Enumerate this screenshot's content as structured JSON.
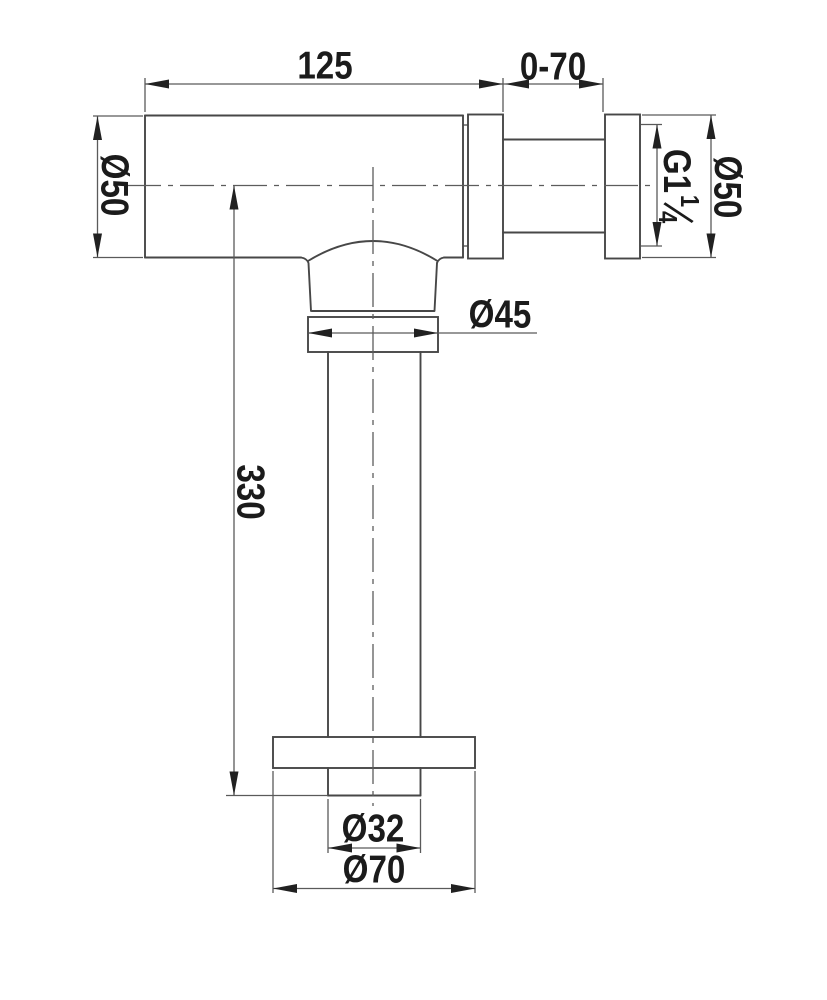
{
  "drawing": {
    "labels": {
      "body_length": "125",
      "telescopic_range": "0-70",
      "inlet_diameter_left": "Ø50",
      "inlet_diameter_right": "Ø50",
      "thread_prefix": "G1",
      "thread_fraction_numerator": "1",
      "thread_fraction_denominator": "4",
      "trap_nut_diameter": "Ø45",
      "tailpipe_length": "330",
      "tailpipe_diameter": "Ø32",
      "flange_diameter": "Ø70"
    },
    "colors": {
      "background": "#ffffff",
      "object_line": "#474747",
      "dimension_line": "#5a5a5a",
      "centerline": "#5c5c5c",
      "text": "#1b1b1b",
      "arrowhead": "#212121"
    }
  }
}
